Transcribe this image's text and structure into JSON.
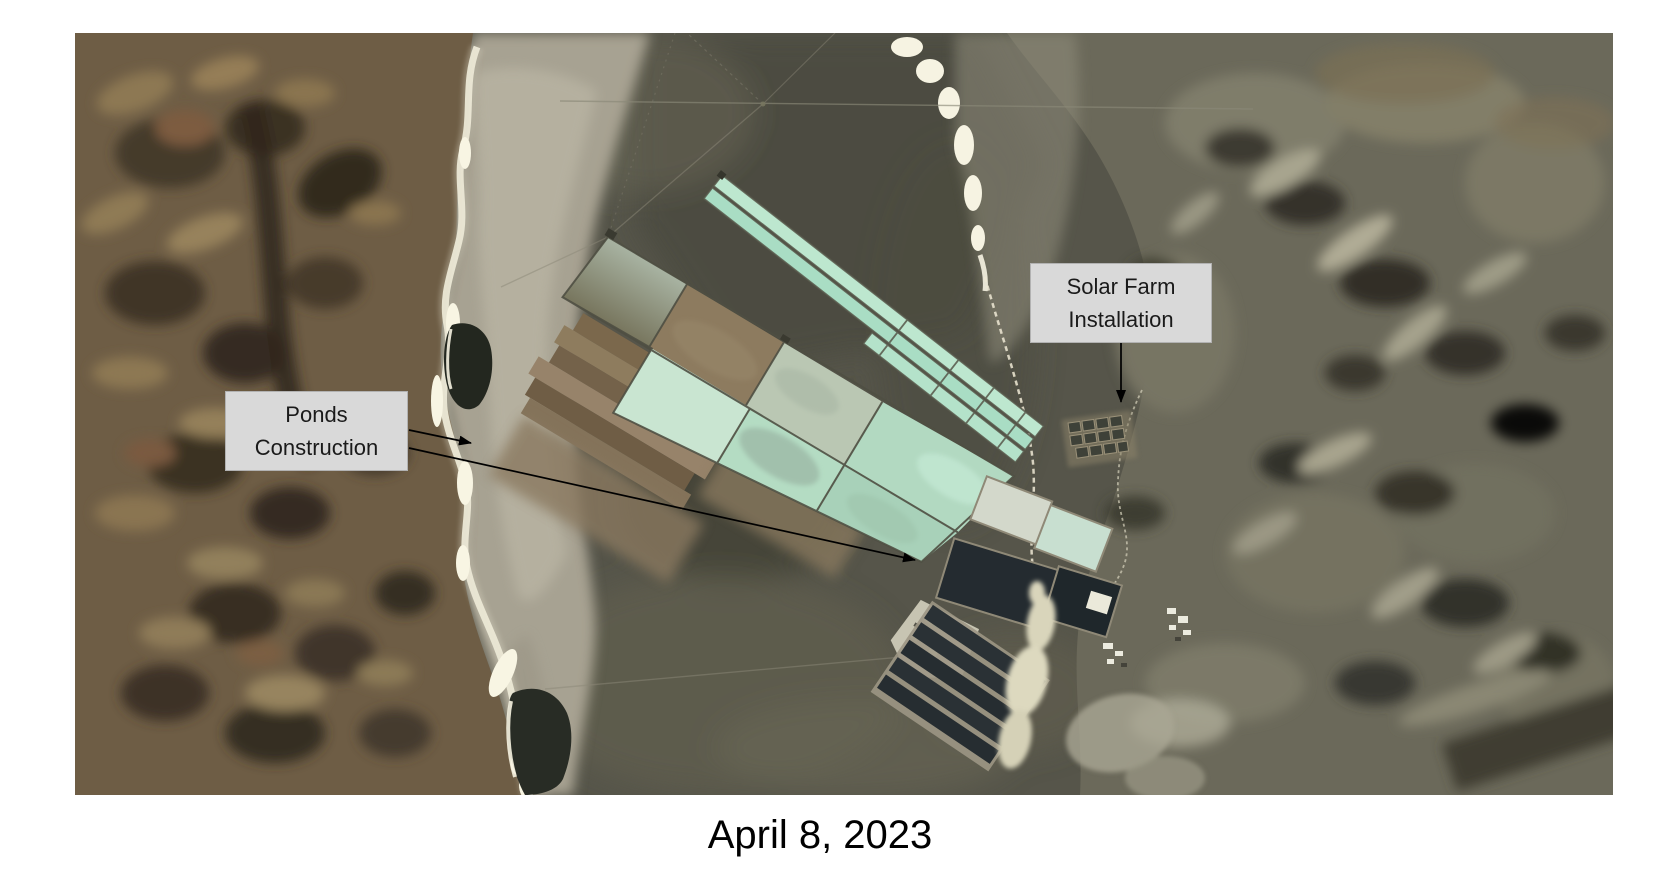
{
  "figure": {
    "caption": "April 8, 2023",
    "annotations": {
      "ponds": {
        "line1": "Ponds",
        "line2": "Construction"
      },
      "solar": {
        "line1": "Solar Farm",
        "line2": "Installation"
      }
    },
    "colors": {
      "label_background": "#d9d9d9",
      "label_text": "#1a1a1a",
      "arrow": "#000000",
      "caption_text": "#000000",
      "pond_mint": "#b7dcc5",
      "pond_pale_mint": "#cde8d6",
      "pond_dark": "#252d31",
      "salt_white": "#f4f1df",
      "terrain_left_brown": "#6e5d45",
      "terrain_right_olive": "#6b695a",
      "playa_olive": "#56554a",
      "construction_tan": "#8c7b5e"
    }
  }
}
